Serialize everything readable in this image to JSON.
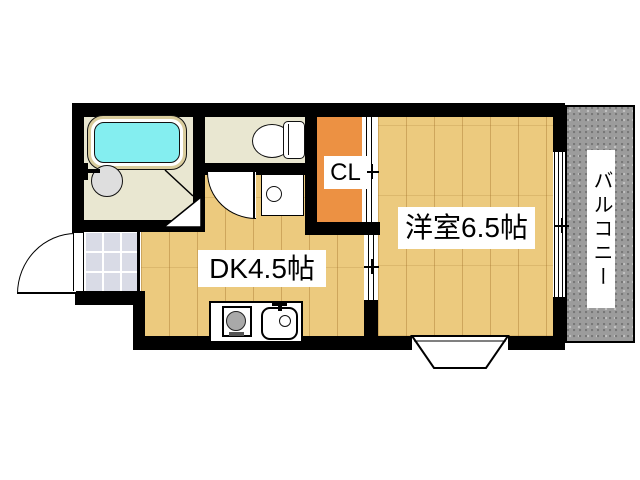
{
  "rooms": {
    "western": {
      "label": "洋室6.5帖"
    },
    "dk": {
      "label": "DK4.5帖"
    },
    "closet": {
      "label": "CL"
    },
    "balcony": {
      "label": "バルコニー"
    }
  },
  "colors": {
    "wall": "#000000",
    "wood": "#ecca7e",
    "cream": "#e9e7d1",
    "closet": "#ec9143",
    "tile": "#d9dbe6",
    "water": "#84eef0",
    "rim": "#d9cc9c",
    "balcony": "#9c9c9c",
    "label_bg": "#ffffff",
    "label_text": "#000000"
  },
  "fixtures": {
    "bathtub": "bathtub",
    "washbasin": "washbasin",
    "toilet": "toilet",
    "washing_machine_pan": "washing-machine-pan",
    "stove": "stove",
    "kitchen_sink": "kitchen-sink",
    "bay_window": "bay-window",
    "entrance_door": "entrance-door",
    "toilet_door": "toilet-door",
    "bath_folding_door": "bath-folding-door",
    "closet_sliding_door": "closet-sliding-door",
    "room_sliding_door": "room-sliding-door",
    "balcony_window": "balcony-window"
  }
}
